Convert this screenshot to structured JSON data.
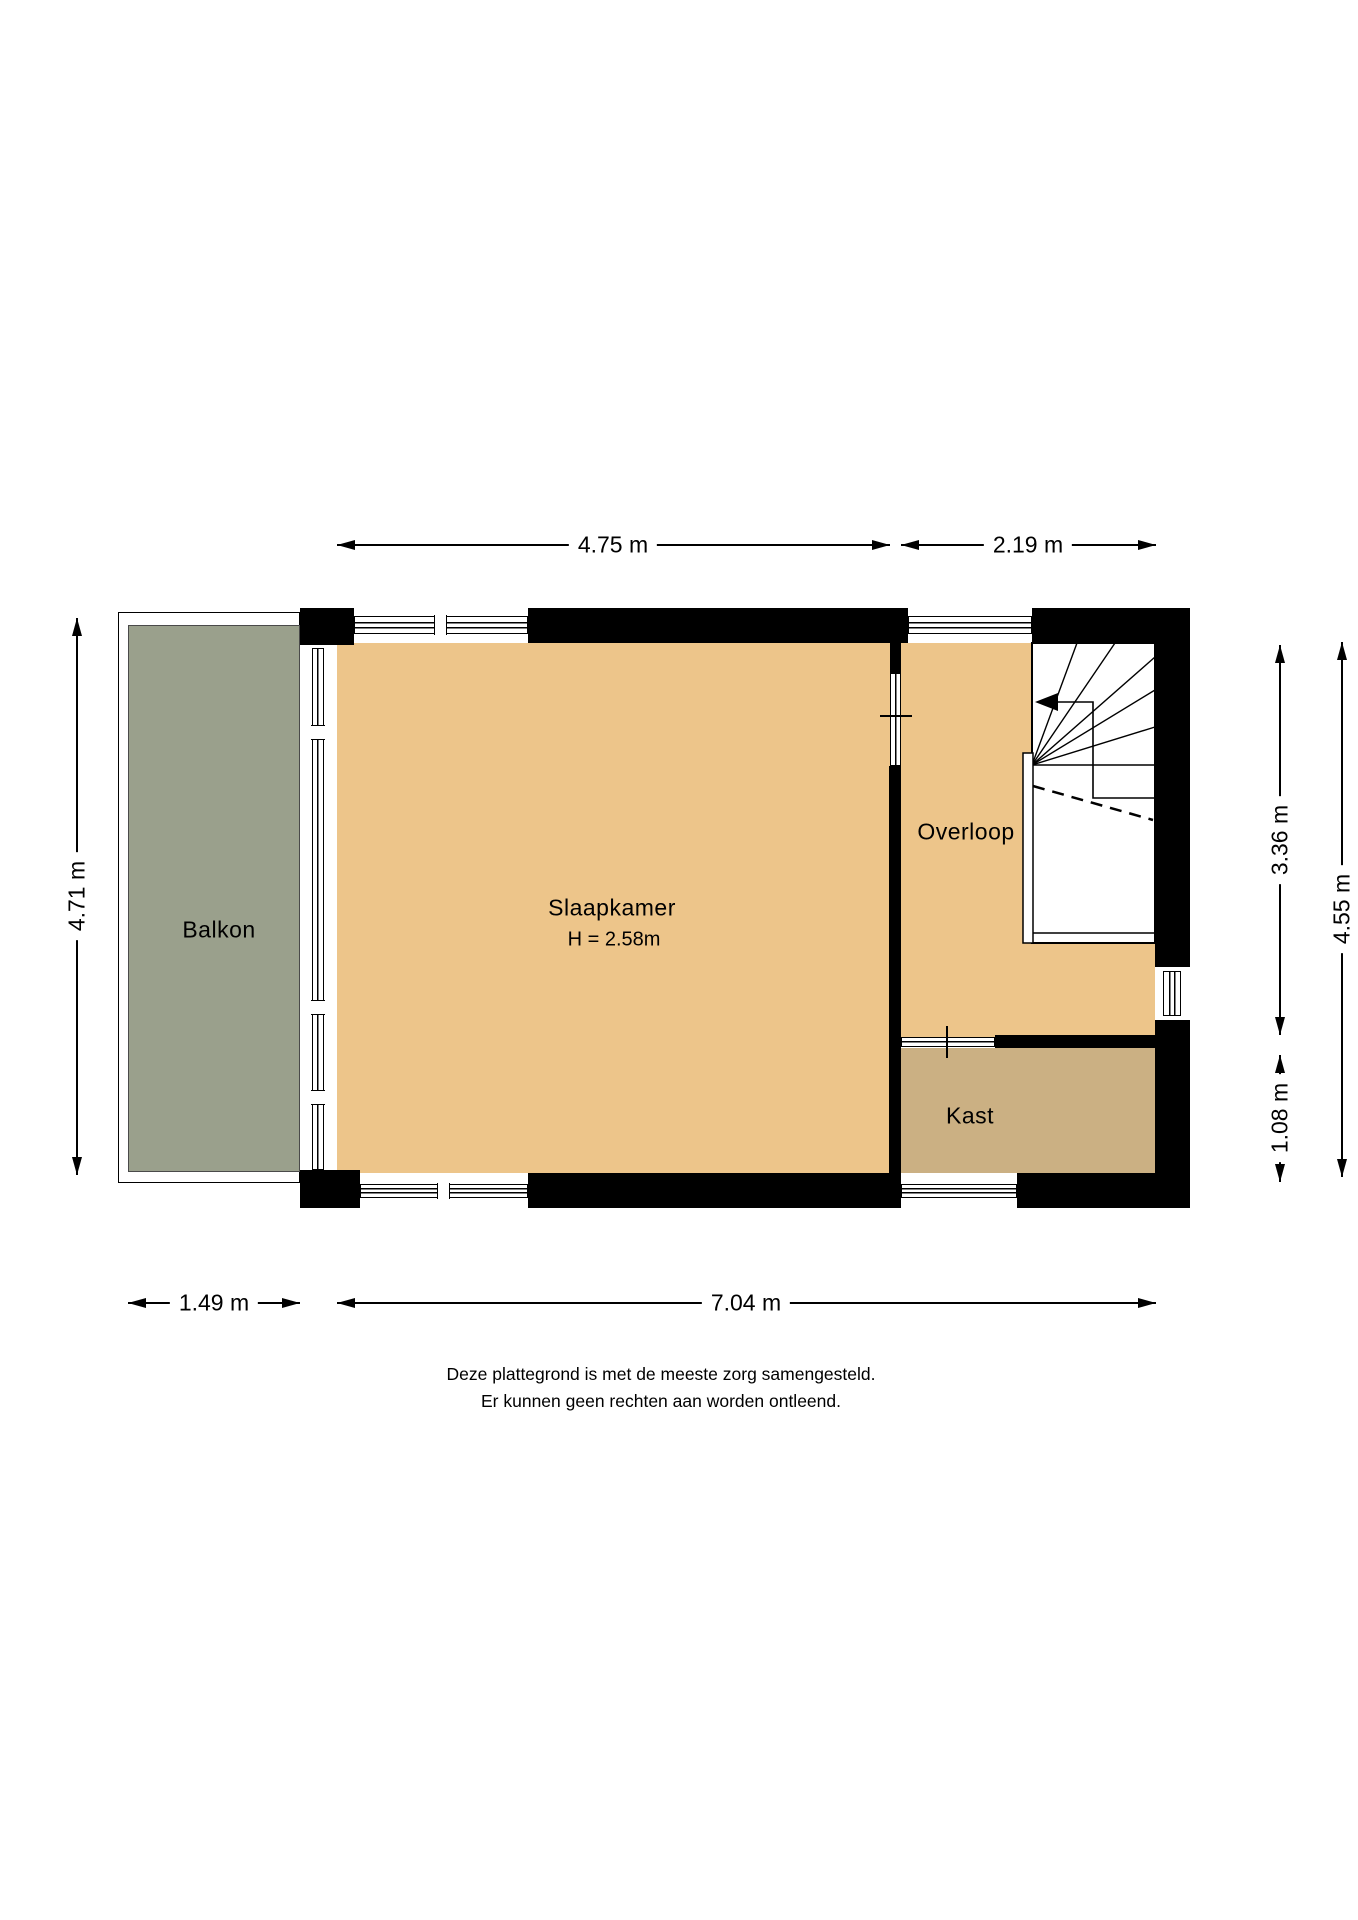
{
  "plan": {
    "rooms": {
      "balcony": {
        "label": "Balkon"
      },
      "bedroom": {
        "label": "Slaapkamer",
        "ceiling_height": "H = 2.58m"
      },
      "landing": {
        "label": "Overloop"
      },
      "closet": {
        "label": "Kast"
      }
    },
    "dimensions": {
      "bedroom_width": "4.75 m",
      "landing_width": "2.19 m",
      "balcony_height": "4.71 m",
      "landing_depth": "3.36 m",
      "closet_depth": "1.08 m",
      "right_total_depth": "4.55 m",
      "balcony_width": "1.49 m",
      "building_width": "7.04 m"
    },
    "features": [
      "stairs-winder",
      "walk-direction-arrow"
    ],
    "disclaimer": {
      "line1": "Deze plattegrond is met de meeste zorg samengesteld.",
      "line2": "Er kunnen geen rechten aan worden ontleend."
    }
  },
  "colors": {
    "floor": "#edc58a",
    "closet_floor": "#cbb083",
    "balcony_floor": "#9aa08c",
    "wall": "#000000"
  }
}
